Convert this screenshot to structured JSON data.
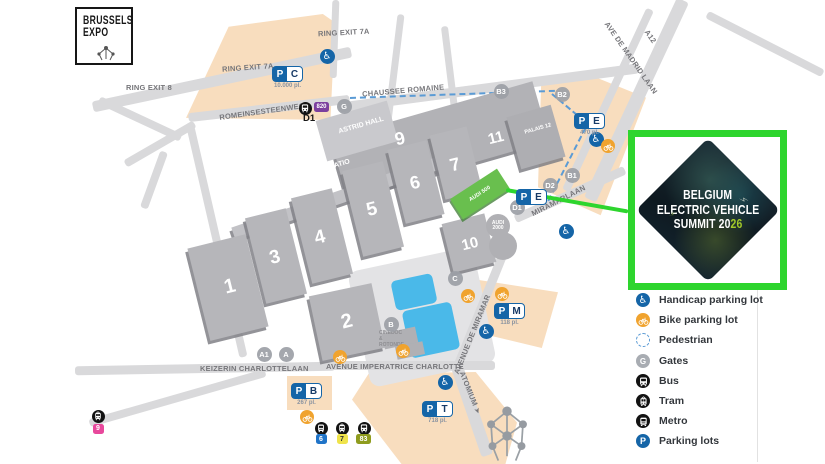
{
  "logo": {
    "line1": "BRUSSELS",
    "line2": "EXPO"
  },
  "icons": {
    "lightning": "⚡",
    "wheelchair": "♿"
  },
  "roads": {
    "ring_exit_8": "RING EXIT 8",
    "ring_exit_7a": "RING EXIT 7A",
    "romeinsesteenweg": "ROMEINSESTEENWEG",
    "chaussee_romaine": "CHAUSSEE ROMAINE",
    "ave_de_madrid_laan": "AVE DE MADRID LAAN",
    "a12": "A12",
    "miramarlaan": "MIRAMARLAAN",
    "avenue_de_miramar": "AVENUE DE MIRAMAR",
    "keizerin_charlottelaan": "KEIZERIN CHARLOTTELAAN",
    "avenue_imperatrice_charlotte": "AVENUE IMPERATRICE CHARLOTTE",
    "atomium": "ATOMIUM ➤"
  },
  "buildings": {
    "halls": [
      "1",
      "2",
      "3",
      "4",
      "5",
      "6",
      "7",
      "8",
      "9",
      "10",
      "11"
    ],
    "astrid_hall": "ASTRID HALL",
    "patio": "PATIO",
    "palais_12": "PALAIS 12",
    "audi_500": "AUDI 500",
    "audi_2000": "AUDI 2000",
    "cinedoc_rotonde": "CINEDOC & ROTONDE"
  },
  "parkings": {
    "p_label": "P",
    "lots": [
      {
        "letter": "C",
        "places": "10.000 pl."
      },
      {
        "letter": "E",
        "places": "470 pl."
      },
      {
        "letter": "E",
        "places": ""
      },
      {
        "letter": "M",
        "places": "118 pl."
      },
      {
        "letter": "B",
        "places": "267 pl."
      },
      {
        "letter": "T",
        "places": "718 pl."
      }
    ]
  },
  "gates": [
    "G",
    "B3",
    "B2",
    "B1",
    "D2",
    "D1",
    "C",
    "B",
    "A1",
    "A"
  ],
  "transit": {
    "d1_label": "D1",
    "routes": {
      "bus_820": "820",
      "tram_9": "9",
      "metro_6": "6",
      "tram_7": "7",
      "bus_83": "83"
    }
  },
  "callout": {
    "line1": "BELGIUM",
    "line2": "ELECTRIC VEHICLE",
    "line3": "SUMMIT 20",
    "line3_accent": "26"
  },
  "legend": {
    "items": [
      {
        "label": "Handicap parking lot"
      },
      {
        "label": "Bike parking lot"
      },
      {
        "label": "Pedestrian"
      },
      {
        "label": "Gates",
        "icon_letter": "G"
      },
      {
        "label": "Bus"
      },
      {
        "label": "Tram"
      },
      {
        "label": "Metro"
      },
      {
        "label": "Parking lots"
      }
    ]
  },
  "colors": {
    "accent_green": "#2ed52e",
    "summit_accent": "#a3c929",
    "beige": "#f8ddbe",
    "hall_gray": "#b6b6ba",
    "water_blue": "#4ab9e9",
    "parking_blue": "#1565a7",
    "bike_orange": "#f0a32e",
    "route_820_purple": "#7c3f9e",
    "route_9_pink": "#e8489c",
    "route_6_blue": "#2074c8",
    "route_7_yellow": "#efe34b",
    "route_83_olive": "#8f9c1e"
  }
}
